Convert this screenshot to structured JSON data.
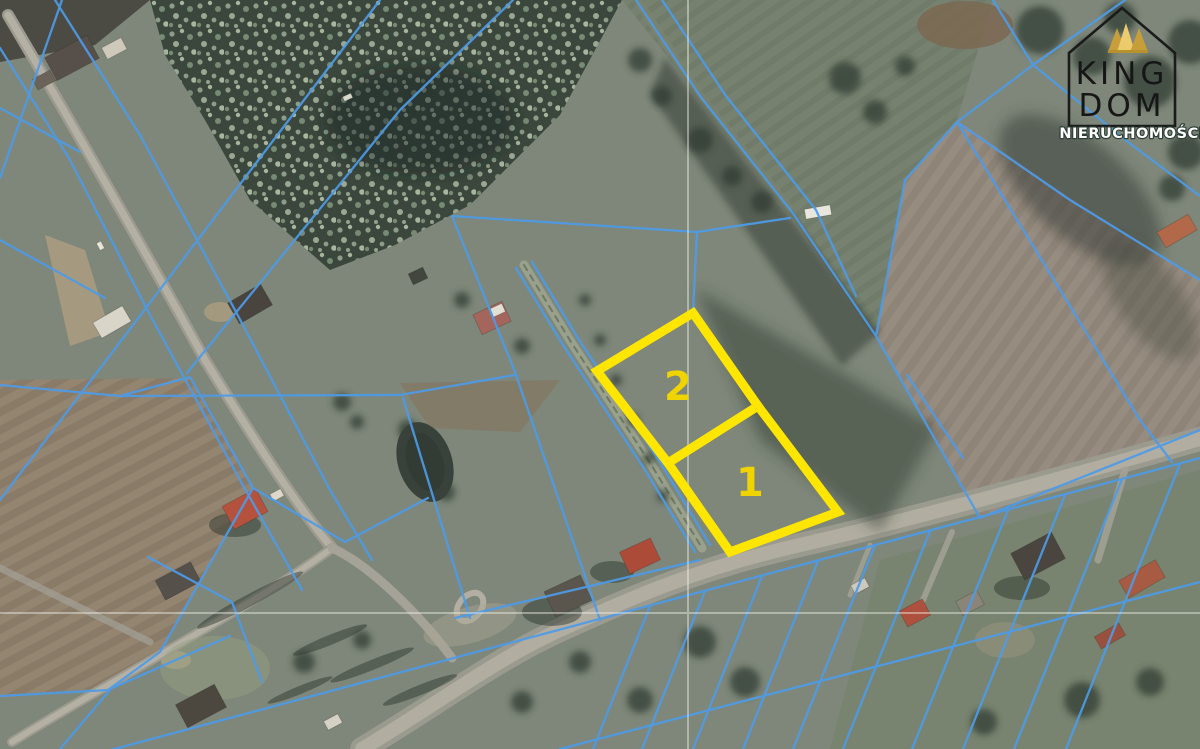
{
  "map": {
    "type": "aerial-cadastral-map",
    "parcels": [
      {
        "label": "2",
        "points": "693,313 758,406 668,463 597,371"
      },
      {
        "label": "1",
        "points": "758,406 838,512 730,552 668,463"
      }
    ],
    "colors": {
      "highlight": "#FFE600",
      "parcel_label": "#EFD400",
      "cadastral_line": "#4E9BE8",
      "crosshair": "#F0EFE8"
    }
  },
  "logo": {
    "name_line1": "KING",
    "name_line2": "DOM",
    "subtitle": "NIERUCHOMOŚCI",
    "colors": {
      "crown": "#D8AC4C",
      "outline": "#1B1B1B",
      "subtitle_text": "#FFFFFF"
    }
  }
}
